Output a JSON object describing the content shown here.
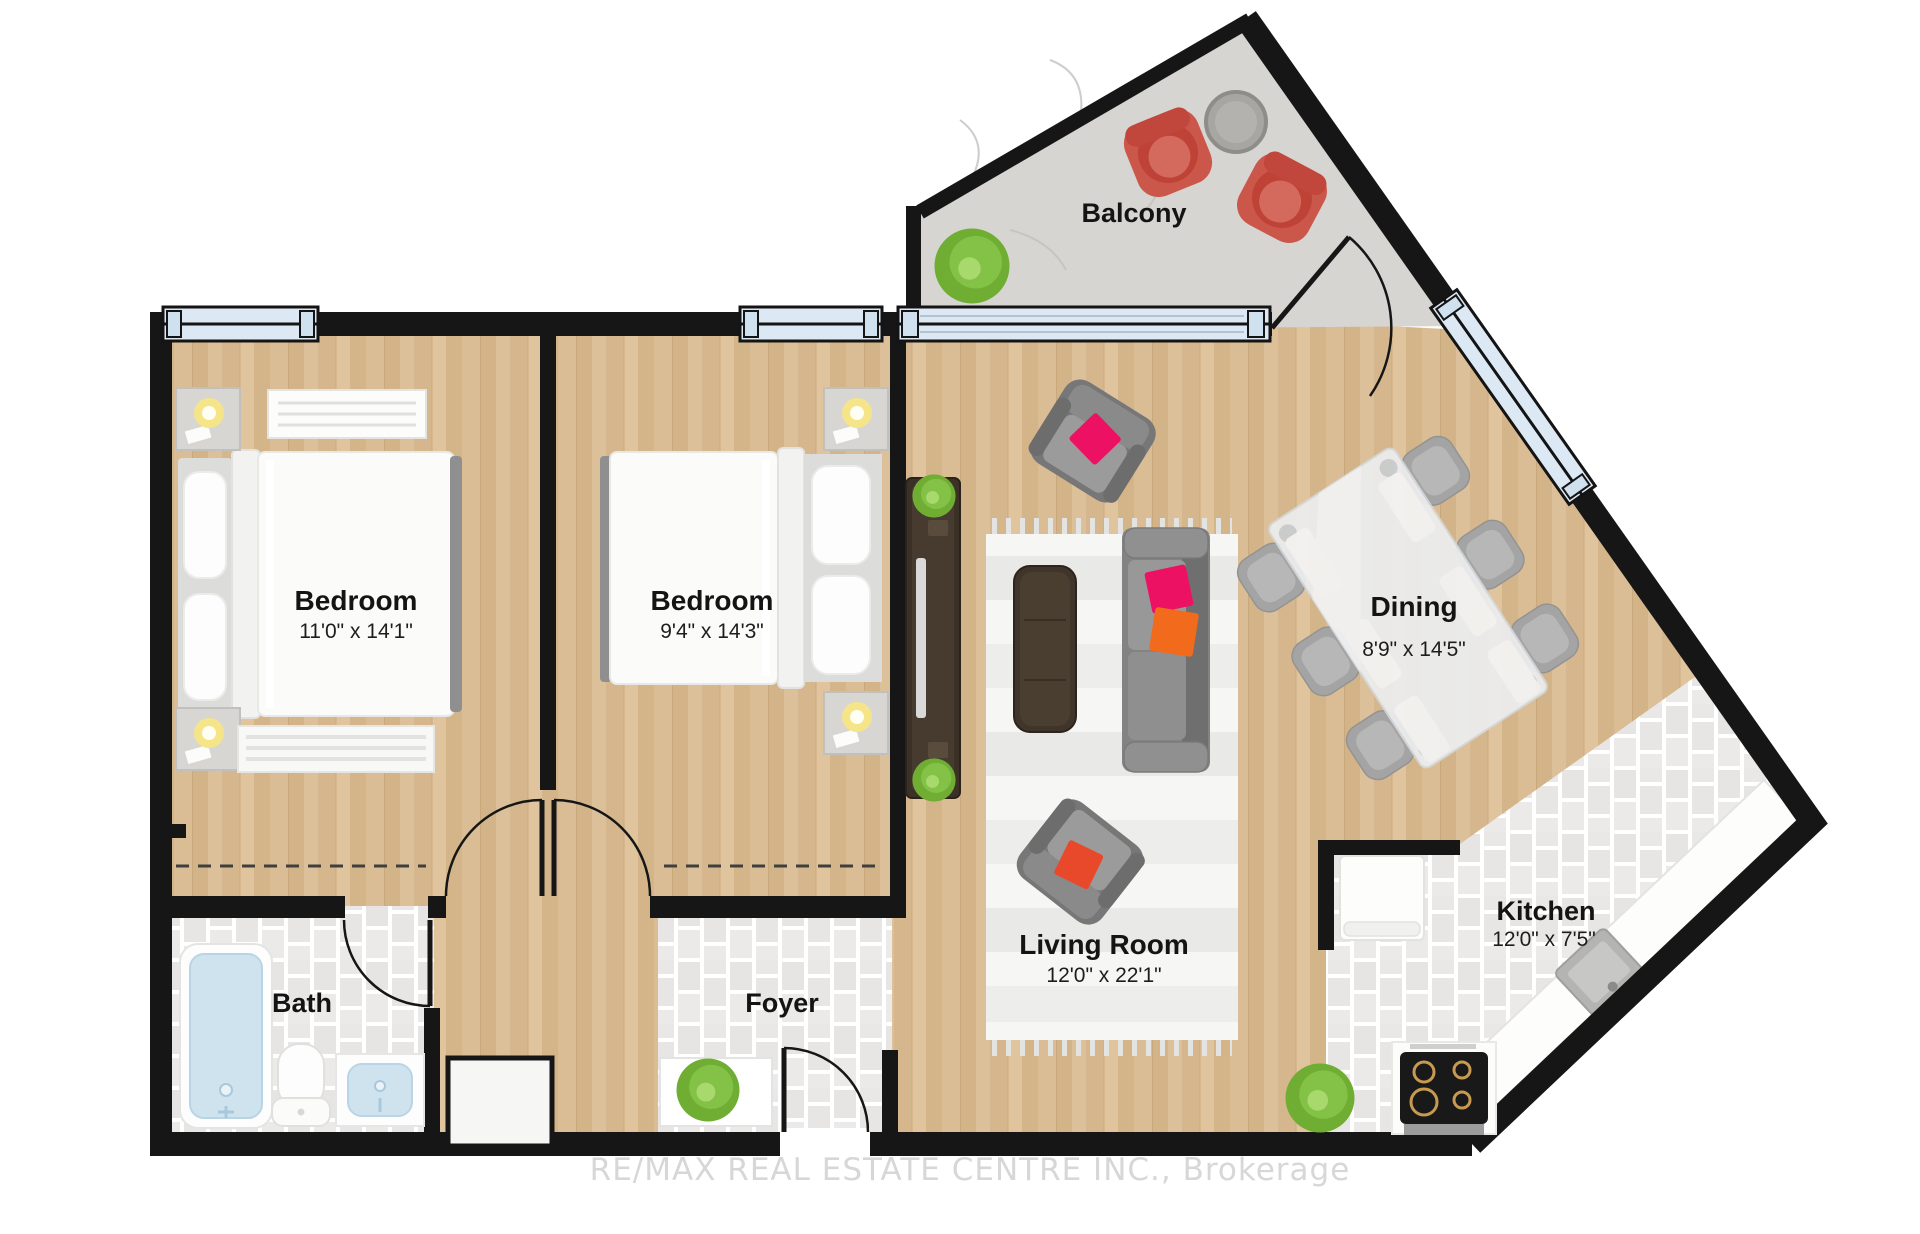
{
  "rooms": {
    "balcony": {
      "name": "Balcony"
    },
    "bedroom1": {
      "name": "Bedroom",
      "dims": "11'0\" x 14'1\""
    },
    "bedroom2": {
      "name": "Bedroom",
      "dims": "9'4\" x 14'3\""
    },
    "dining": {
      "name": "Dining",
      "dims": "8'9\" x 14'5\""
    },
    "living": {
      "name": "Living Room",
      "dims": "12'0\" x 22'1\""
    },
    "kitchen": {
      "name": "Kitchen",
      "dims": "12'0\" x 7'5\""
    },
    "bath": {
      "name": "Bath"
    },
    "foyer": {
      "name": "Foyer"
    }
  },
  "watermark": {
    "text": "RE/MAX REAL ESTATE CENTRE INC., Brokerage"
  },
  "colors": {
    "wall": "#161616",
    "wood_floor": "#d9bc93",
    "tile_floor": "#e8e7e5",
    "balcony_concrete": "#d6d5d2",
    "window_glass": "#dce9f4",
    "accent_pink": "#ed1164",
    "accent_orange": "#f26a1b",
    "accent_red": "#e8492b",
    "balcony_chair_red": "#cb574a",
    "plant_green": "#74b63a"
  }
}
